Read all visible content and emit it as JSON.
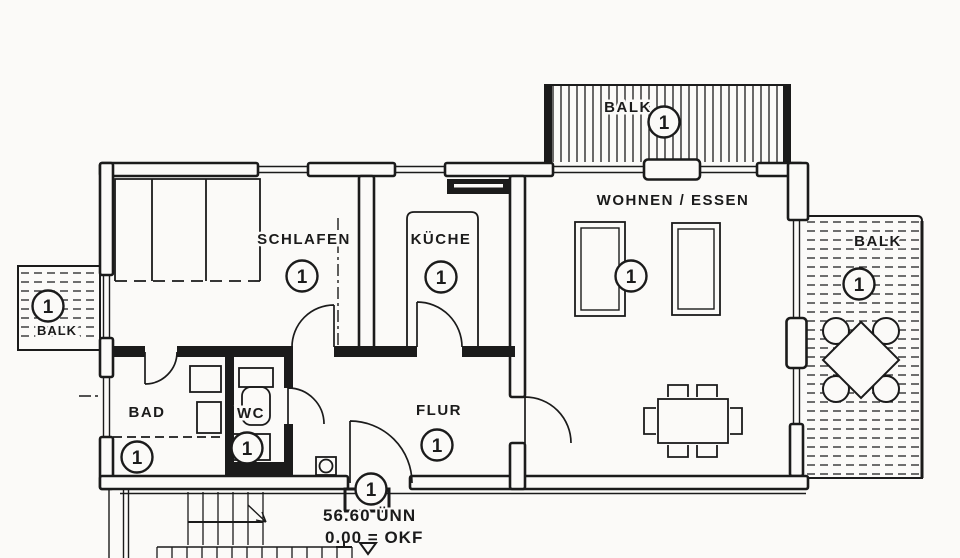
{
  "colors": {
    "ink": "#1b1b1b",
    "paper": "#fbfaf8"
  },
  "rooms": {
    "schlafen": {
      "label": "SCHLAFEN",
      "unit": "1"
    },
    "kueche": {
      "label": "KÜCHE",
      "unit": "1"
    },
    "wohnen_essen": {
      "label": "WOHNEN / ESSEN",
      "unit": "1"
    },
    "bad": {
      "label": "BAD",
      "unit": "1"
    },
    "wc": {
      "label": "WC",
      "unit": "1"
    },
    "flur": {
      "label": "FLUR",
      "unit": "1"
    }
  },
  "balconies": {
    "top": {
      "label": "BALK",
      "unit": "1"
    },
    "right": {
      "label": "BALK",
      "unit": "1"
    },
    "left": {
      "label": "BALK",
      "unit": "1"
    }
  },
  "entrance": {
    "unit": "1"
  },
  "annotations": {
    "elevation_level": "56.60 ÜNN",
    "elevation_datum": "0.00 = OKF"
  }
}
